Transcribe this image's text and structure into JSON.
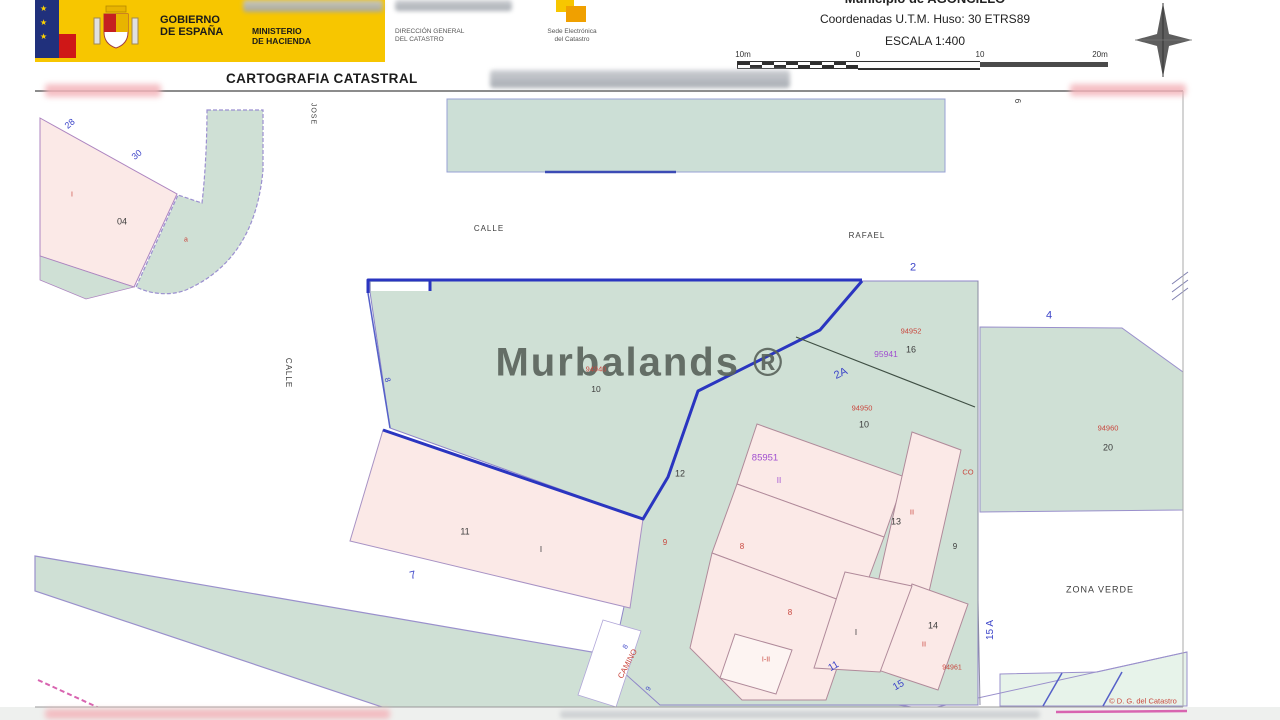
{
  "colors": {
    "banner_yellow": "#f7c600",
    "green_fill": "#cfe0d5",
    "green_light": "#e7f3ea",
    "pink_fill": "#fbe9e7",
    "navy_line": "#2a35c0",
    "purple_line": "#9a90cc",
    "magenta_line": "#d864b0",
    "label_colors": {
      "blue": "#3b43c8",
      "red": "#c9473e",
      "purple": "#a14fd0",
      "dark": "#3c3c3c"
    }
  },
  "header": {
    "gobierno_line1": "GOBIERNO",
    "gobierno_line2": "DE ESPAÑA",
    "ministerio_line1": "MINISTERIO",
    "ministerio_line2": "DE HACIENDA",
    "direccion_line1": "DIRECCIÓN GENERAL",
    "direccion_line2": "DEL CATASTRO",
    "sede_line1": "Sede Electrónica",
    "sede_line2": "del Catastro",
    "municipio": "Municipio de AGONCILLO",
    "coordenadas": "Coordenadas U.T.M. Huso: 30 ETRS89",
    "escala": "ESCALA 1:400",
    "title": "CARTOGRAFIA CATASTRAL"
  },
  "scalebar": {
    "labels": [
      "10m",
      "0",
      "10",
      "20m"
    ]
  },
  "map": {
    "watermark": "Murbalands ®",
    "labels": [
      {
        "text": "CALLE",
        "x": 489,
        "y": 229,
        "c": "dark",
        "s": 8,
        "ls": 1
      },
      {
        "text": "RAFAEL",
        "x": 867,
        "y": 236,
        "c": "dark",
        "s": 8,
        "ls": 1
      },
      {
        "text": "CALLE",
        "x": 288,
        "y": 373,
        "c": "dark",
        "s": 8,
        "r": 90,
        "ls": 1
      },
      {
        "text": "JOSE",
        "x": 313,
        "y": 114,
        "c": "dark",
        "s": 7,
        "r": 90,
        "ls": 1
      },
      {
        "text": "ZONA VERDE",
        "x": 1100,
        "y": 590,
        "c": "dark",
        "s": 9,
        "ls": 1
      },
      {
        "text": "28",
        "x": 70,
        "y": 124,
        "c": "blue",
        "s": 9,
        "r": -40
      },
      {
        "text": "30",
        "x": 137,
        "y": 155,
        "c": "blue",
        "s": 9,
        "r": -40
      },
      {
        "text": "2",
        "x": 913,
        "y": 268,
        "c": "blue",
        "s": 11
      },
      {
        "text": "4",
        "x": 1049,
        "y": 316,
        "c": "blue",
        "s": 11
      },
      {
        "text": "7",
        "x": 413,
        "y": 576,
        "c": "blue",
        "s": 11,
        "r": -15
      },
      {
        "text": "8",
        "x": 387,
        "y": 380,
        "c": "blue",
        "s": 8,
        "r": 75
      },
      {
        "text": "2A",
        "x": 841,
        "y": 374,
        "c": "blue",
        "s": 11,
        "r": -25
      },
      {
        "text": "11",
        "x": 834,
        "y": 667,
        "c": "blue",
        "s": 10,
        "r": -30
      },
      {
        "text": "15",
        "x": 899,
        "y": 686,
        "c": "blue",
        "s": 10,
        "r": -30
      },
      {
        "text": "15 A",
        "x": 991,
        "y": 630,
        "c": "blue",
        "s": 10,
        "r": -90
      },
      {
        "text": "8",
        "x": 626,
        "y": 647,
        "c": "blue",
        "s": 7,
        "r": -62
      },
      {
        "text": "9",
        "x": 649,
        "y": 689,
        "c": "blue",
        "s": 7,
        "r": -62
      },
      {
        "text": "I",
        "x": 72,
        "y": 195,
        "c": "red",
        "s": 7
      },
      {
        "text": "a",
        "x": 186,
        "y": 240,
        "c": "red",
        "s": 7
      },
      {
        "text": "94940",
        "x": 596,
        "y": 369,
        "c": "red",
        "s": 7.5
      },
      {
        "text": "94952",
        "x": 911,
        "y": 331,
        "c": "red",
        "s": 7.5
      },
      {
        "text": "94950",
        "x": 862,
        "y": 408,
        "c": "red",
        "s": 7.5
      },
      {
        "text": "94960",
        "x": 1108,
        "y": 428,
        "c": "red",
        "s": 7.5
      },
      {
        "text": "94961",
        "x": 952,
        "y": 668,
        "c": "red",
        "s": 7
      },
      {
        "text": "CO",
        "x": 968,
        "y": 472,
        "c": "red",
        "s": 7.5
      },
      {
        "text": "8",
        "x": 742,
        "y": 547,
        "c": "red",
        "s": 8
      },
      {
        "text": "8",
        "x": 790,
        "y": 613,
        "c": "red",
        "s": 8
      },
      {
        "text": "9",
        "x": 665,
        "y": 543,
        "c": "red",
        "s": 8
      },
      {
        "text": "II",
        "x": 912,
        "y": 512,
        "c": "red",
        "s": 7.5
      },
      {
        "text": "II",
        "x": 924,
        "y": 644,
        "c": "red",
        "s": 7.5
      },
      {
        "text": "I-II",
        "x": 766,
        "y": 660,
        "c": "red",
        "s": 7
      },
      {
        "text": "CAMINO",
        "x": 628,
        "y": 664,
        "c": "red",
        "s": 8,
        "r": -62
      },
      {
        "text": "© D. G. del Catastro",
        "x": 1143,
        "y": 701,
        "c": "red",
        "s": 7.5
      },
      {
        "text": "95941",
        "x": 886,
        "y": 354,
        "c": "purple",
        "s": 8.5
      },
      {
        "text": "85951",
        "x": 765,
        "y": 458,
        "c": "purple",
        "s": 9.5
      },
      {
        "text": "II",
        "x": 779,
        "y": 481,
        "c": "purple",
        "s": 8
      },
      {
        "text": "04",
        "x": 122,
        "y": 222,
        "c": "dark",
        "s": 9
      },
      {
        "text": "6",
        "x": 1017,
        "y": 101,
        "c": "dark",
        "s": 8,
        "r": 90
      },
      {
        "text": "16",
        "x": 911,
        "y": 350,
        "c": "dark",
        "s": 9
      },
      {
        "text": "10",
        "x": 596,
        "y": 389,
        "c": "dark",
        "s": 8.5
      },
      {
        "text": "10",
        "x": 864,
        "y": 425,
        "c": "dark",
        "s": 9
      },
      {
        "text": "12",
        "x": 680,
        "y": 474,
        "c": "dark",
        "s": 9
      },
      {
        "text": "11",
        "x": 465,
        "y": 532,
        "c": "dark",
        "s": 9
      },
      {
        "text": "I",
        "x": 541,
        "y": 550,
        "c": "dark",
        "s": 8
      },
      {
        "text": "13",
        "x": 896,
        "y": 522,
        "c": "dark",
        "s": 9
      },
      {
        "text": "9",
        "x": 955,
        "y": 547,
        "c": "dark",
        "s": 8
      },
      {
        "text": "14",
        "x": 933,
        "y": 626,
        "c": "dark",
        "s": 9
      },
      {
        "text": "I",
        "x": 856,
        "y": 633,
        "c": "dark",
        "s": 8
      },
      {
        "text": "20",
        "x": 1108,
        "y": 448,
        "c": "dark",
        "s": 9
      }
    ]
  }
}
